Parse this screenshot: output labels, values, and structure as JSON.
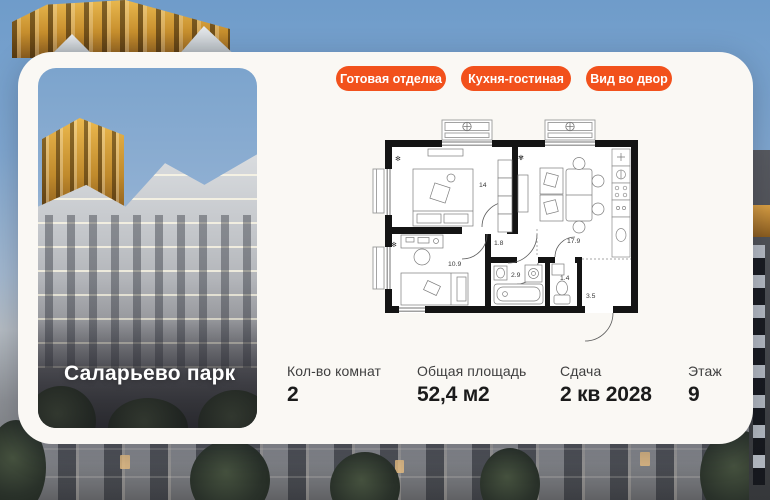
{
  "card": {
    "tags": [
      {
        "label": "Готовая отделка"
      },
      {
        "label": "Кухня-гостиная"
      },
      {
        "label": "Вид во двор"
      }
    ],
    "photo": {
      "project_name": "Саларьево парк"
    },
    "details": [
      {
        "label": "Кол-во комнат",
        "value": "2"
      },
      {
        "label": "Общая площадь",
        "value": "52,4 м2"
      },
      {
        "label": "Сдача",
        "value": "2 кв 2028"
      },
      {
        "label": "Этаж",
        "value": "9"
      }
    ],
    "floorplan": {
      "rooms": [
        {
          "name": "bedroom",
          "area": "14"
        },
        {
          "name": "hallway",
          "area": "1.8"
        },
        {
          "name": "kitchen-living",
          "area": "17.9"
        },
        {
          "name": "bedroom-2",
          "area": "10.9"
        },
        {
          "name": "bathroom",
          "area": "2.9"
        },
        {
          "name": "wc",
          "area": "1.4"
        },
        {
          "name": "entry-hall",
          "area": "3.5"
        }
      ]
    },
    "colors": {
      "accent": "#f2511c",
      "wall": "#141414",
      "card_bg": "#faf8f4"
    }
  }
}
